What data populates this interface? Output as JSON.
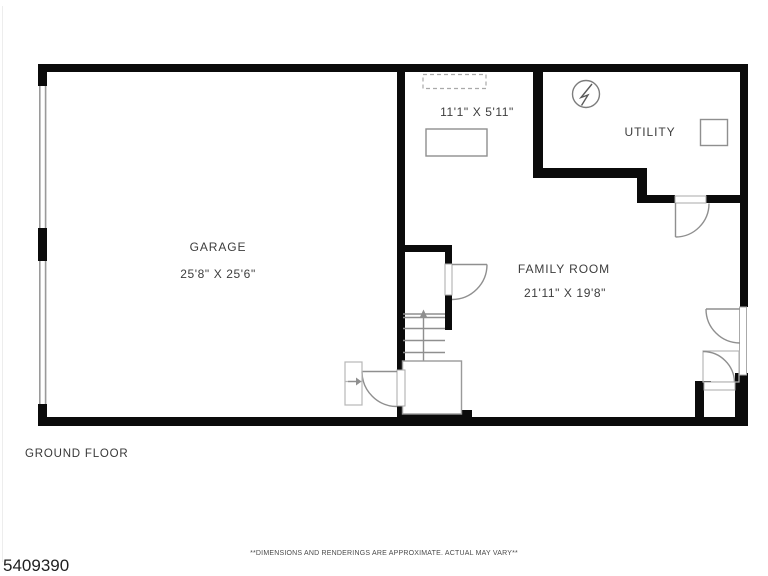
{
  "colors": {
    "wall": "#0b0b0b",
    "thin_line": "#8f8f8f",
    "light_line": "#b7b7b7",
    "label_text": "#3d3d3d",
    "background": "#ffffff"
  },
  "rooms": {
    "garage": {
      "label": "GARAGE",
      "dims": "25'8\" X 25'6\""
    },
    "den": {
      "dims": "11'1\" X 5'11\""
    },
    "utility": {
      "label": "UTILITY"
    },
    "family_room": {
      "label": "FAMILY ROOM",
      "dims": "21'11\" X 19'8\""
    }
  },
  "floor_label": "GROUND FLOOR",
  "footer": {
    "mls_number": "5409390",
    "disclaimer": "**DIMENSIONS AND RENDERINGS ARE APPROXIMATE. ACTUAL MAY VARY**"
  }
}
